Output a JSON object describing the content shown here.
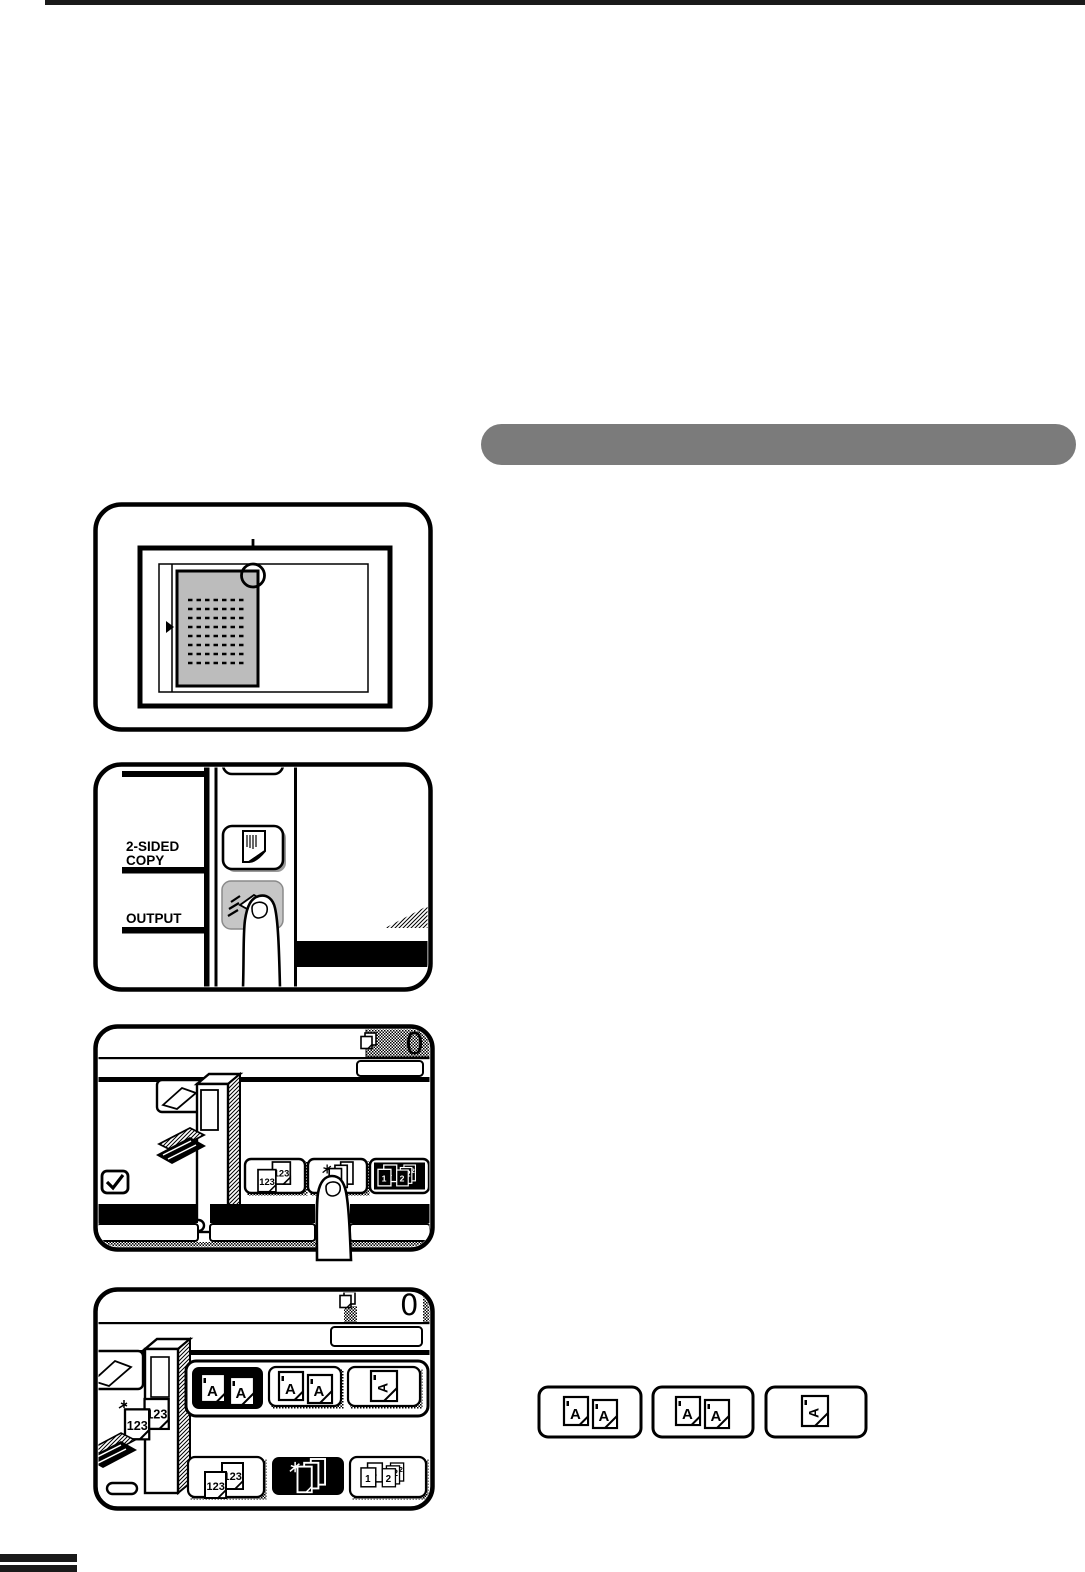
{
  "page": {
    "kind": "copier-user-guide-page",
    "section_header": {
      "title": "",
      "bar_color": "#7b7b7b"
    }
  },
  "panels": {
    "control_panel": {
      "two_sided_label_line1": "2-SIDED",
      "two_sided_label_line2": "COPY",
      "output_label": "OUTPUT"
    },
    "output_screen": {
      "copy_count": "0",
      "buttons": [
        "sort",
        "staple-sort",
        "group"
      ]
    },
    "two_sided_screen": {
      "copy_count": "0",
      "mode_buttons": [
        "1-sided-1-sided",
        "1-sided-2-sided",
        "rotated-original"
      ],
      "output_buttons": [
        "sort",
        "staple-sort",
        "group"
      ]
    }
  },
  "icon_glyphs": {
    "original_letter": "A",
    "sort_numbers": "123",
    "group_digit_first": "1",
    "group_digit_second": "2"
  },
  "colors": {
    "section_bar": "#7b7b7b",
    "ink": "#1a1a1a",
    "key_gray": "#c6c6c6",
    "document_gray": "#bcbcbc"
  }
}
